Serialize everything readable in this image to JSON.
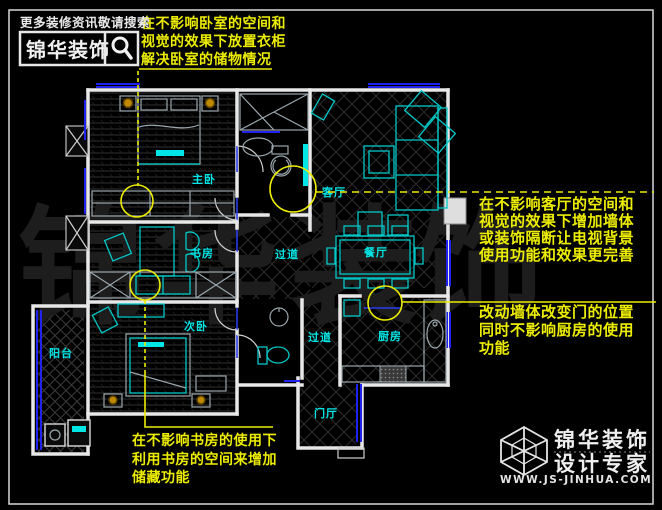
{
  "header": {
    "tagline": "更多装修资讯敬请搜索",
    "brand": "锦华装饰"
  },
  "annotations": {
    "bedroom": {
      "lines": [
        "在不影响卧室的空间和",
        "视觉的效果下放置衣柜",
        "解决卧室的储物情况"
      ]
    },
    "living": {
      "lines": [
        "在不影响客厅的空间和",
        "视觉的效果下增加墙体",
        "或装饰隔断让电视背景",
        "使用功能和效果更完善"
      ]
    },
    "kitchen": {
      "lines": [
        "改动墙体改变门的位置",
        "同时不影响厨房的使用",
        "功能"
      ]
    },
    "study": {
      "lines": [
        "在不影响书房的使用下",
        "利用书房的空间来增加",
        "储藏功能"
      ]
    }
  },
  "rooms": {
    "master": "主卧",
    "study": "书房",
    "second": "次卧",
    "balcony": "阳台",
    "living": "客厅",
    "dining": "餐厅",
    "kitchen": "厨房",
    "foyer": "门厅",
    "corridor1": "过道",
    "corridor2": "过道"
  },
  "watermark": {
    "c1": "锦",
    "c2": "华",
    "c3": "装",
    "c4": "饰"
  },
  "footer": {
    "brand": "锦华装饰",
    "subtitle": "设计专家",
    "website": "WWW.JS-JINHUA.COM"
  },
  "colors": {
    "annotation": "#ecec00",
    "furniture": "#00c8c8",
    "label": "#00e5e5",
    "window": "#2222ee",
    "wall": "#e8e8e8",
    "lamp": "#c08a00"
  }
}
